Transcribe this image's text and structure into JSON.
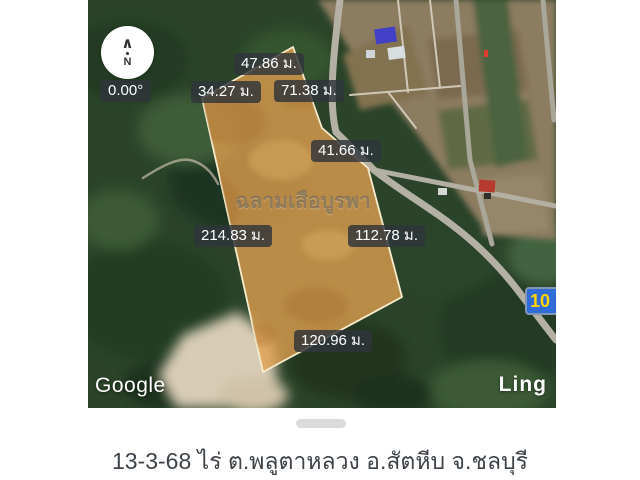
{
  "map": {
    "compass": {
      "arrow_glyph": "∧",
      "letter": "N"
    },
    "rotation_badge": "0.00°",
    "measurements": [
      "47.86 ม.",
      "34.27 ม.",
      "71.38 ม.",
      "41.66 ม.",
      "214.83 ม.",
      "112.78 ม.",
      "120.96 ม."
    ],
    "watermark": "ฉลามเสือบูรพา",
    "attribution": "Google",
    "overlay_label": "Ling",
    "route_badge": "10"
  },
  "caption": "13-3-68 ไร่ ต.พลูตาหลวง อ.สัตหีบ จ.ชลบุรี",
  "colors": {
    "plot_fill": "#E2A050",
    "plot_border": "#F6ECCD",
    "measure_label_bg": "#2F343A",
    "route_badge_bg": "#2F6CD8",
    "route_badge_text": "#FFD400",
    "forest_green": "#2B4429",
    "farmland_tan": "#8C7C60",
    "caption_text": "#3D4348"
  }
}
